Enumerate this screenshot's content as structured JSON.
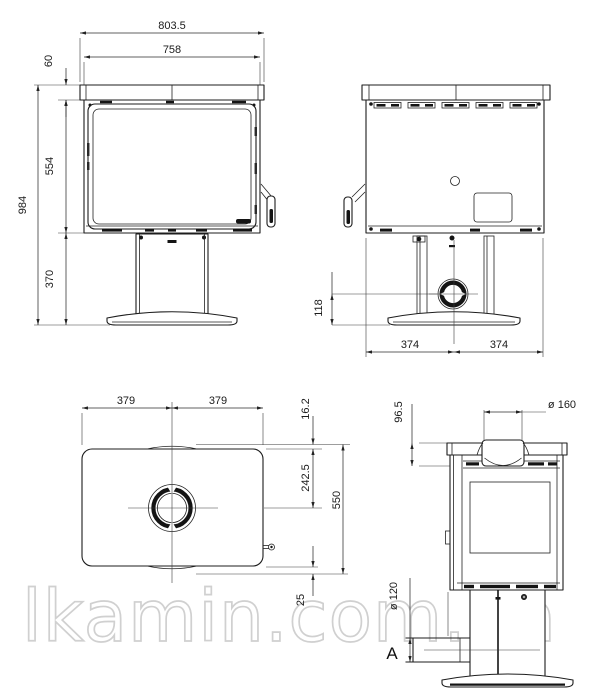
{
  "drawing": {
    "subject": "Freestanding wood-burning stove on pedestal base — four-view dimensional drawing",
    "views": {
      "front": {
        "dims": {
          "overall_width": "803.5",
          "body_width": "758",
          "top_plate_height": "60",
          "firebox_height": "554",
          "pedestal_height": "370",
          "overall_height": "984"
        }
      },
      "rear": {
        "dims": {
          "intake_center_height": "118",
          "half_width_left": "374",
          "half_width_right": "374"
        }
      },
      "top": {
        "dims": {
          "half_width_left": "379",
          "half_width_right": "379",
          "front_edge_offset": "16.2",
          "flue_center_depth": "242.5",
          "overall_depth": "550",
          "rear_edge_offset": "25"
        }
      },
      "side": {
        "dims": {
          "collar_drop": "96.5",
          "flue_diameter": "ø 160",
          "intake_pipe_diameter": "ø 120"
        },
        "labels": {
          "intake_connection": "A"
        }
      }
    }
  },
  "watermark": {
    "text": "lkamin.com.ua",
    "color": "#d0d0d0"
  },
  "colors": {
    "background": "#ffffff",
    "line": "#1d1d1d",
    "dimension": "#222222",
    "watermark_stroke": "#d0d0d0"
  }
}
